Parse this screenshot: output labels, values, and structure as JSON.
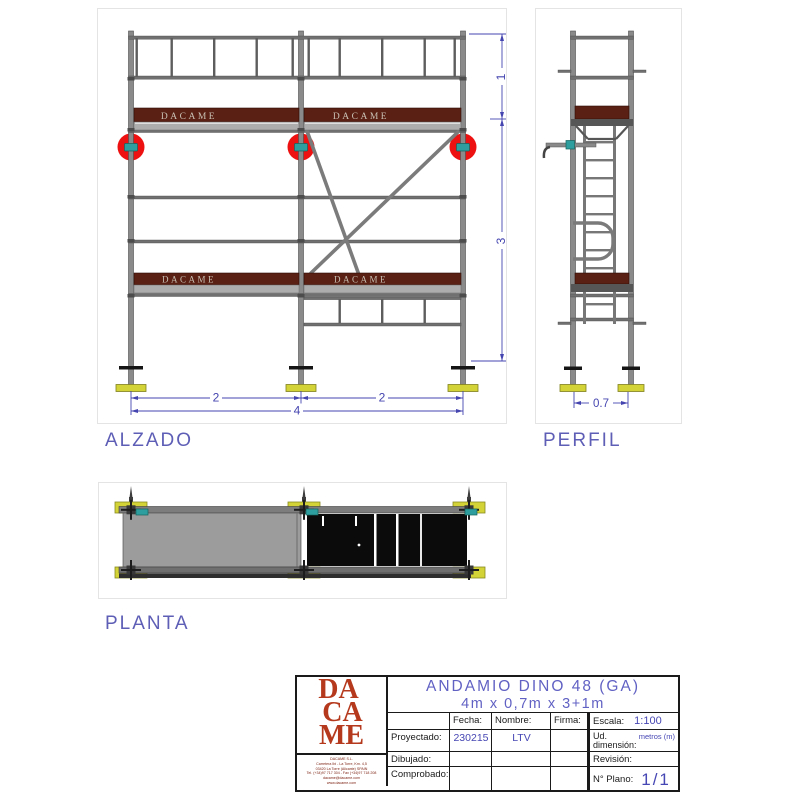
{
  "views": {
    "alzado": {
      "label": "ALZADO",
      "dim_bay_left": "2",
      "dim_bay_right": "2",
      "dim_total": "4",
      "dim_top": "1",
      "dim_main": "3"
    },
    "perfil": {
      "label": "PERFIL",
      "dim_depth": "0.7"
    },
    "planta": {
      "label": "PLANTA"
    },
    "board_brand": "DACAME"
  },
  "title_block": {
    "logo": {
      "line1": "DA",
      "line2": "CA",
      "line3": "ME"
    },
    "fine_print": [
      "DACAME S.L.",
      "Carretera Ibi - La Torre, Km. 4,5",
      "03420 La Torre (Alicante) SPAIN",
      "Tel. (+34)97 717 304 - Fax (+34)97 718 208",
      "dacame@dacame.com",
      "www.dacame.com"
    ],
    "title_line1": "ANDAMIO DINO 48 (GA)",
    "title_line2": "4m x 0,7m x 3+1m",
    "labels": {
      "fecha": "Fecha:",
      "nombre": "Nombre:",
      "firma": "Firma:",
      "proyectado": "Proyectado:",
      "dibujado": "Dibujado:",
      "comprobado": "Comprobado:",
      "escala": "Escala:",
      "ud1": "Ud.",
      "ud2": "dimensión:",
      "revision": "Revisión:",
      "plano": "N° Plano:"
    },
    "values": {
      "escala": "1:100",
      "fecha_proyectado": "230215",
      "nombre_proyectado": "LTV",
      "ud": "metros (m)",
      "plano": "1/1"
    }
  },
  "colors": {
    "dim_blue": "#4545b0",
    "label_blue": "#5e5eb6",
    "title_blue": "#6161c4",
    "value_blue": "#4646b4",
    "logo_red": "#b5391d",
    "toeboard_maroon": "#5a2013",
    "anchor_red": "#ee1111",
    "teal": "#2f9e9e",
    "base_yellow": "#d3d337",
    "steel_gray": "#8a8a8a"
  }
}
